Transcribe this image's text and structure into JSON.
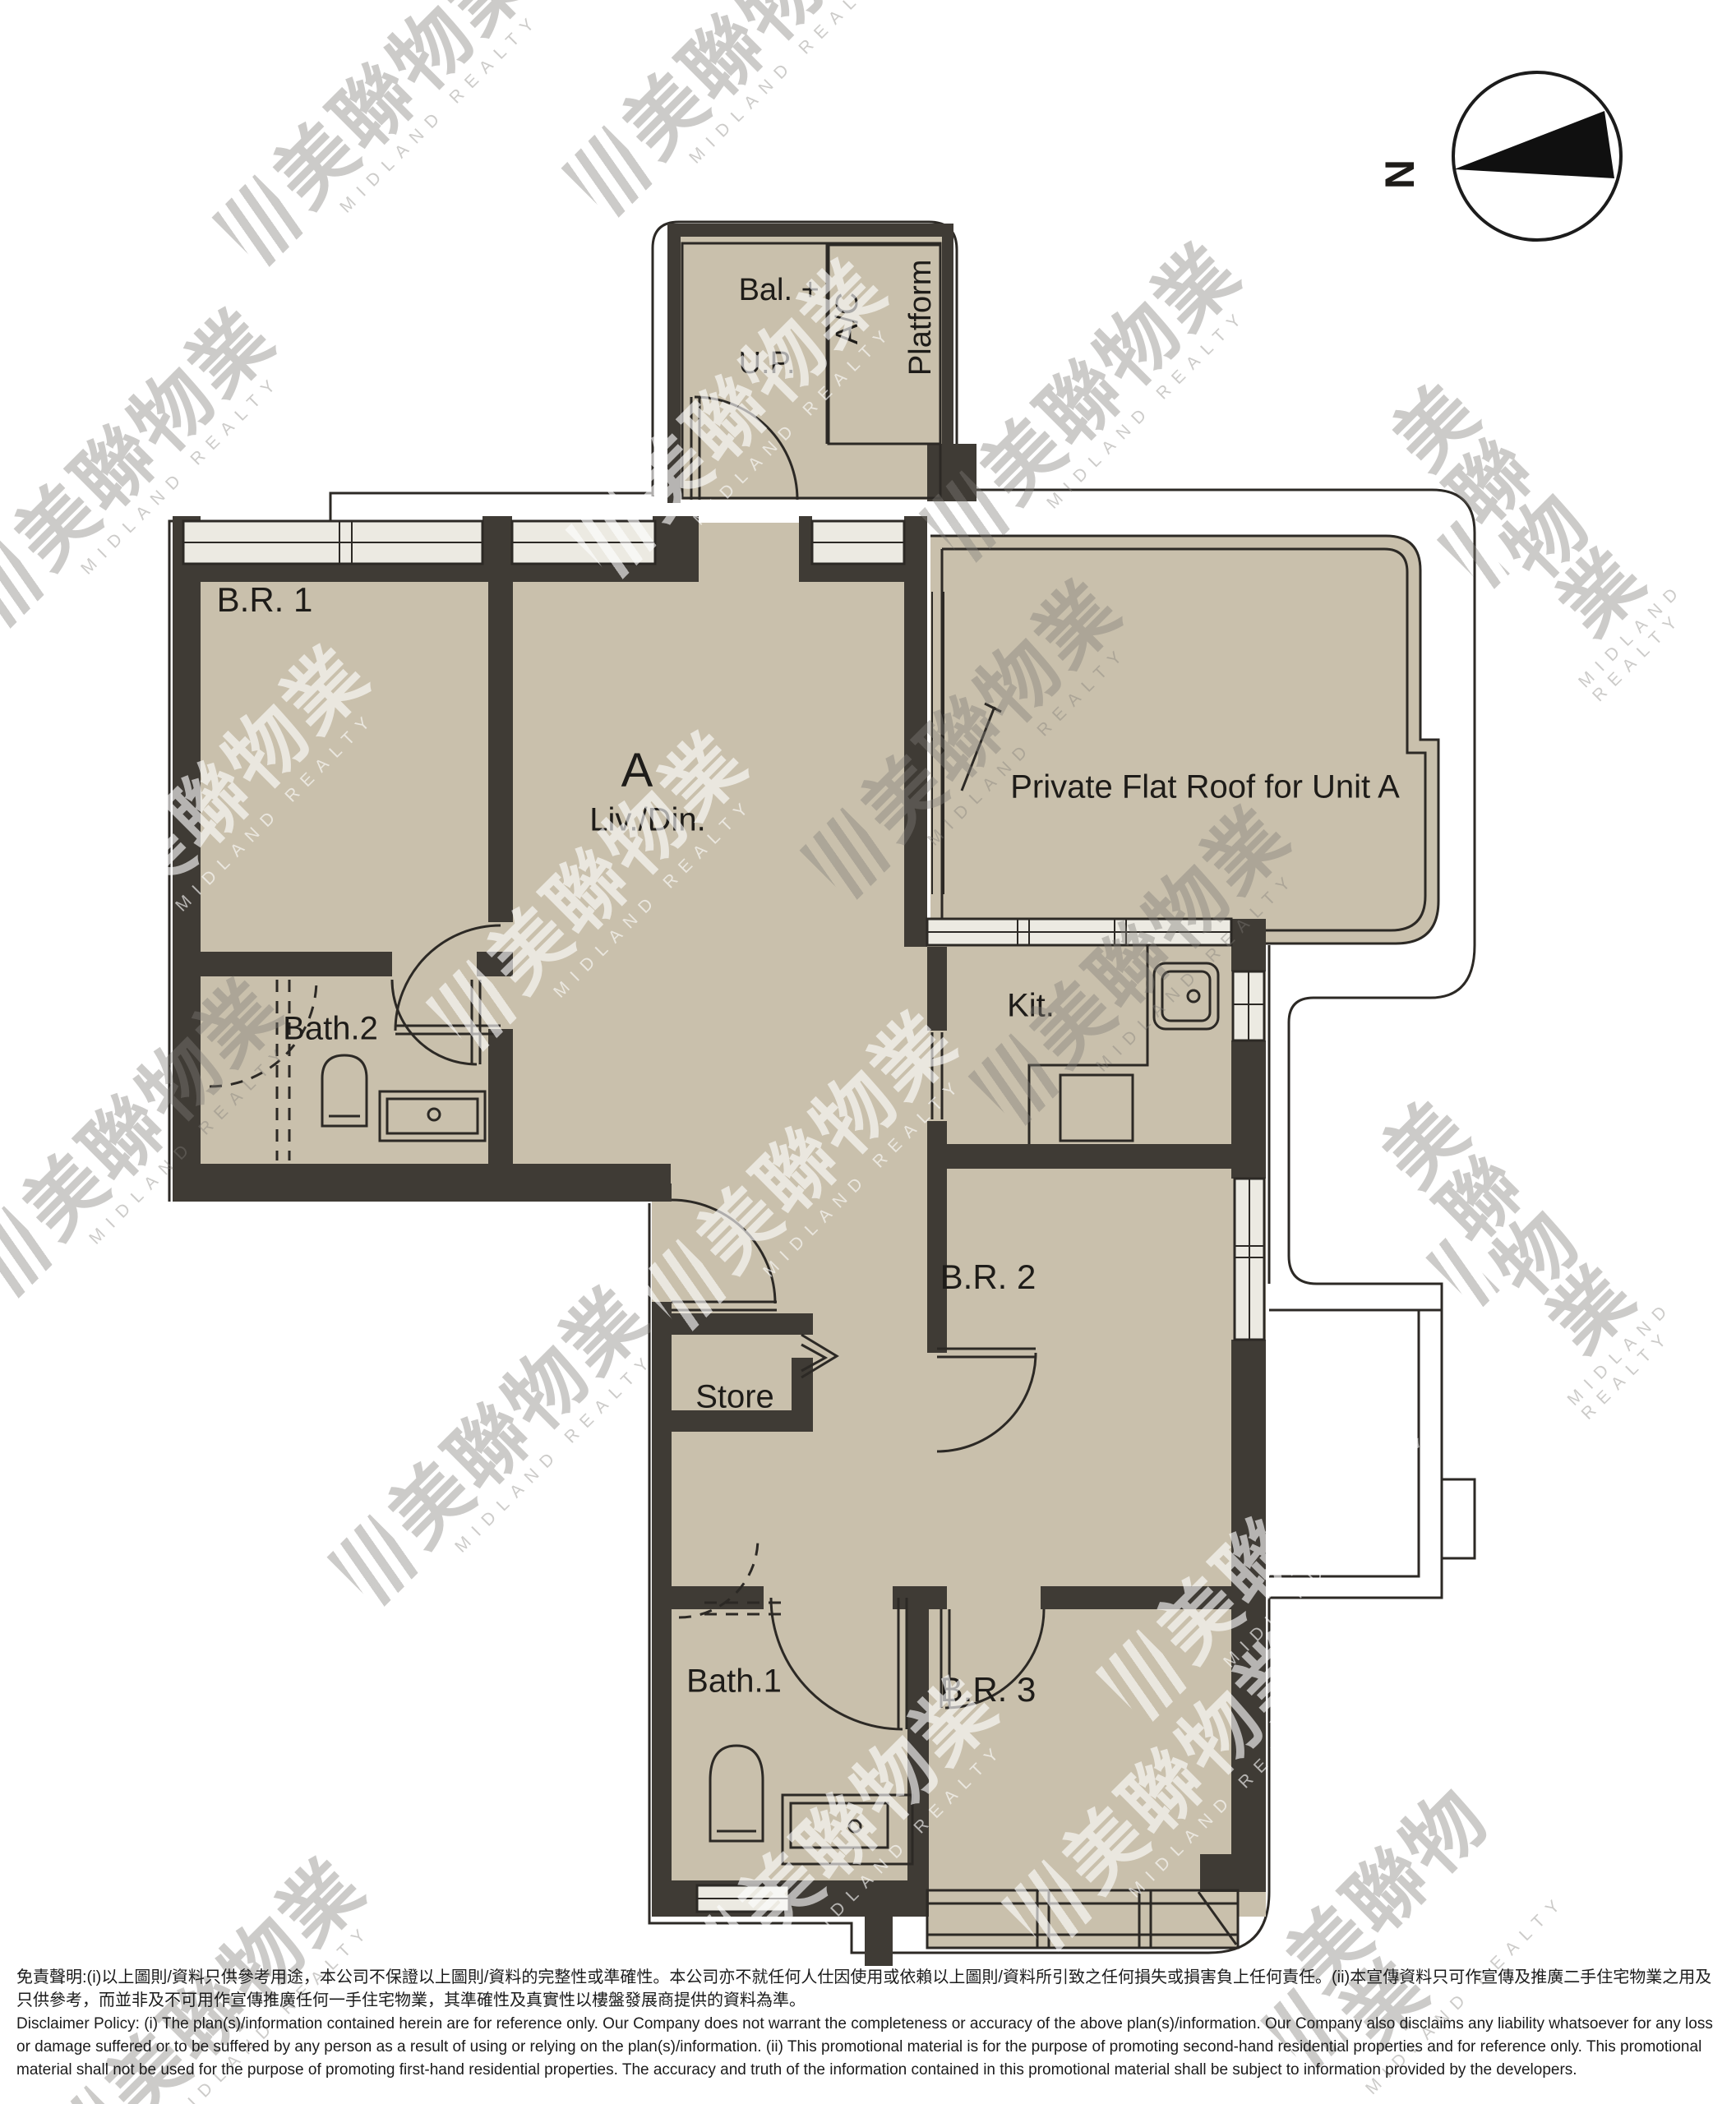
{
  "compass": {
    "north": "N"
  },
  "rooms": {
    "br1": "B.R. 1",
    "unit": "A",
    "living": "Liv./Din.",
    "flat_roof": "Private Flat Roof for Unit A",
    "bath2": "Bath.2",
    "kitchen": "Kit.",
    "br2": "B.R. 2",
    "store": "Store",
    "bath1": "Bath.1",
    "br3": "B.R. 3",
    "balcony_line1": "Bal. +",
    "balcony_line2": "U.P.",
    "ac_line1": "A/C",
    "ac_line2": "Platform"
  },
  "watermark": {
    "cjk": "美聯物業",
    "latin": "MIDLAND REALTY"
  },
  "disclaimer": {
    "zh": "免責聲明:(i)以上圖則/資料只供參考用途，本公司不保證以上圖則/資料的完整性或準確性。本公司亦不就任何人仕因使用或依賴以上圖則/資料所引致之任何損失或損害負上任何責任。(ii)本宣傳資料只可作宣傳及推廣二手住宅物業之用及只供參考，而並非及不可用作宣傳推廣任何一手住宅物業，其準確性及真實性以樓盤發展商提供的資料為準。",
    "en": "Disclaimer Policy: (i) The plan(s)/information contained herein are for reference only. Our Company does not warrant the completeness or accuracy of the above plan(s)/information. Our Company also disclaims any liability whatsoever for any loss or damage suffered or to be suffered by any person as a result of using or relying on the plan(s)/information. (ii) This promotional material is for the purpose of promoting second-hand residential properties and for reference only. This promotional material shall not be used for the purpose of promoting first-hand residential properties. The accuracy and truth of the information contained in this promotional material shall be subject to information provided by the developers."
  },
  "colors": {
    "floor": "#c9c0ac",
    "wall": "#3f3b35",
    "line": "#2c2925",
    "window_fill": "#eceae2",
    "watermark_dark": "#817e79",
    "watermark_light": "#ffffff"
  }
}
